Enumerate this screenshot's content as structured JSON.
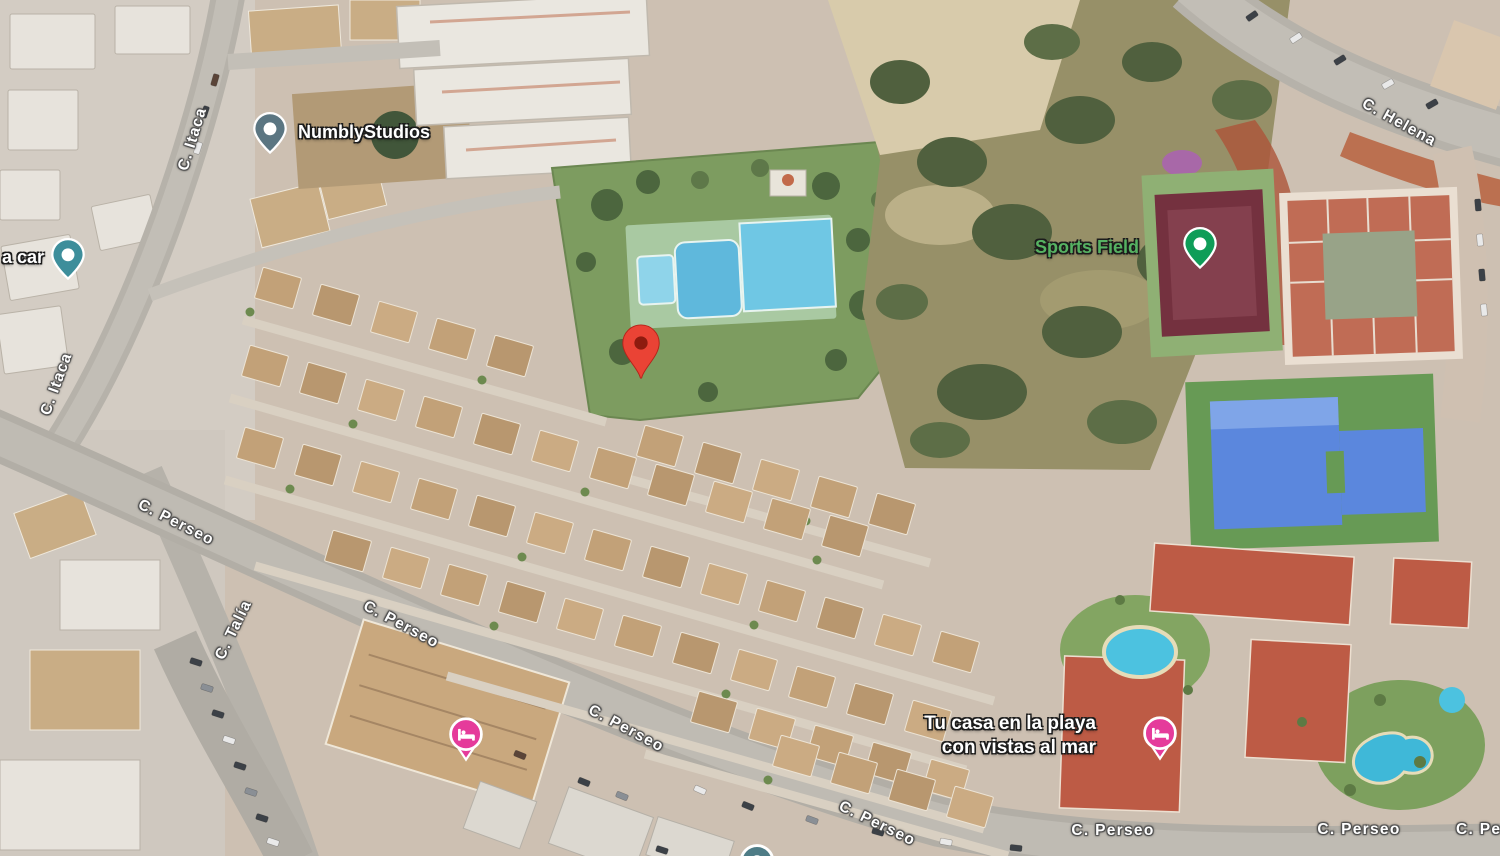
{
  "app": {
    "view": "satellite-map"
  },
  "streets": [
    {
      "name": "C. Itaca"
    },
    {
      "name": "C. Itaca"
    },
    {
      "name": "C. Helena"
    },
    {
      "name": "C. Perseo"
    },
    {
      "name": "C. Talía"
    },
    {
      "name": "C. Perseo"
    },
    {
      "name": "C. Perseo"
    },
    {
      "name": "C. Perseo"
    },
    {
      "name": "C. Perseo"
    },
    {
      "name": "C. Perseo"
    },
    {
      "name": "C. Perseo"
    }
  ],
  "pois": [
    {
      "label": "NumblyStudios",
      "pin_color": "#5B7682",
      "icon": "place-dot"
    },
    {
      "label": "a car",
      "pin_color": "#3D8E9B",
      "icon": "place-dot"
    },
    {
      "label": "Sports Field",
      "pin_color": "#0F9D58",
      "label_color": "#56B262",
      "icon": "place-dot"
    },
    {
      "label_line1": "Tu casa en la playa",
      "label_line2": "con vistas al mar",
      "pin_color": "#E53B9B",
      "icon": "lodging-bed"
    },
    {
      "pin_color": "#E53B9B",
      "icon": "lodging-bed"
    },
    {
      "pin_color": "#4E7C86",
      "icon": "place-dot"
    }
  ],
  "marker": {
    "color": "#EA4335",
    "inner_color": "#8E1B0F"
  }
}
